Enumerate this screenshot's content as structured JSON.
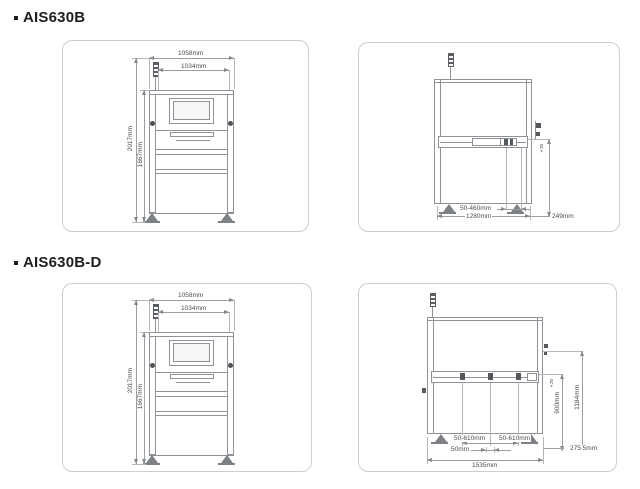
{
  "sections": {
    "s1": {
      "title": "AIS630B",
      "front": {
        "width_outer": "1058mm",
        "width_inner": "1034mm",
        "height_total": "2017mm",
        "height_body": "1667mm"
      },
      "side": {
        "pcb_width_range": "50-460mm",
        "depth": "1280mm",
        "exit_extension": "249mm",
        "tolerance": "±20"
      }
    },
    "s2": {
      "title": "AIS630B-D",
      "front": {
        "width_outer": "1058mm",
        "width_inner": "1034mm",
        "height_total": "2017mm",
        "height_body": "1667mm"
      },
      "side": {
        "lane1_range": "50-610mm",
        "lane2_range": "50-610mm",
        "lane_gap": "50mm",
        "depth_total": "1535mm",
        "exit_extension": "275.5mm",
        "conveyor_height": "900mm",
        "upper_height": "1184mm",
        "tolerance": "±20"
      }
    }
  },
  "colors": {
    "drawing_line": "#8f9298",
    "dimension_line": "#9b9ea4",
    "dimension_text": "#4b4d51",
    "panel_border": "#cdced1",
    "title_text": "#1f1f23",
    "detail_dark": "#55585d"
  }
}
